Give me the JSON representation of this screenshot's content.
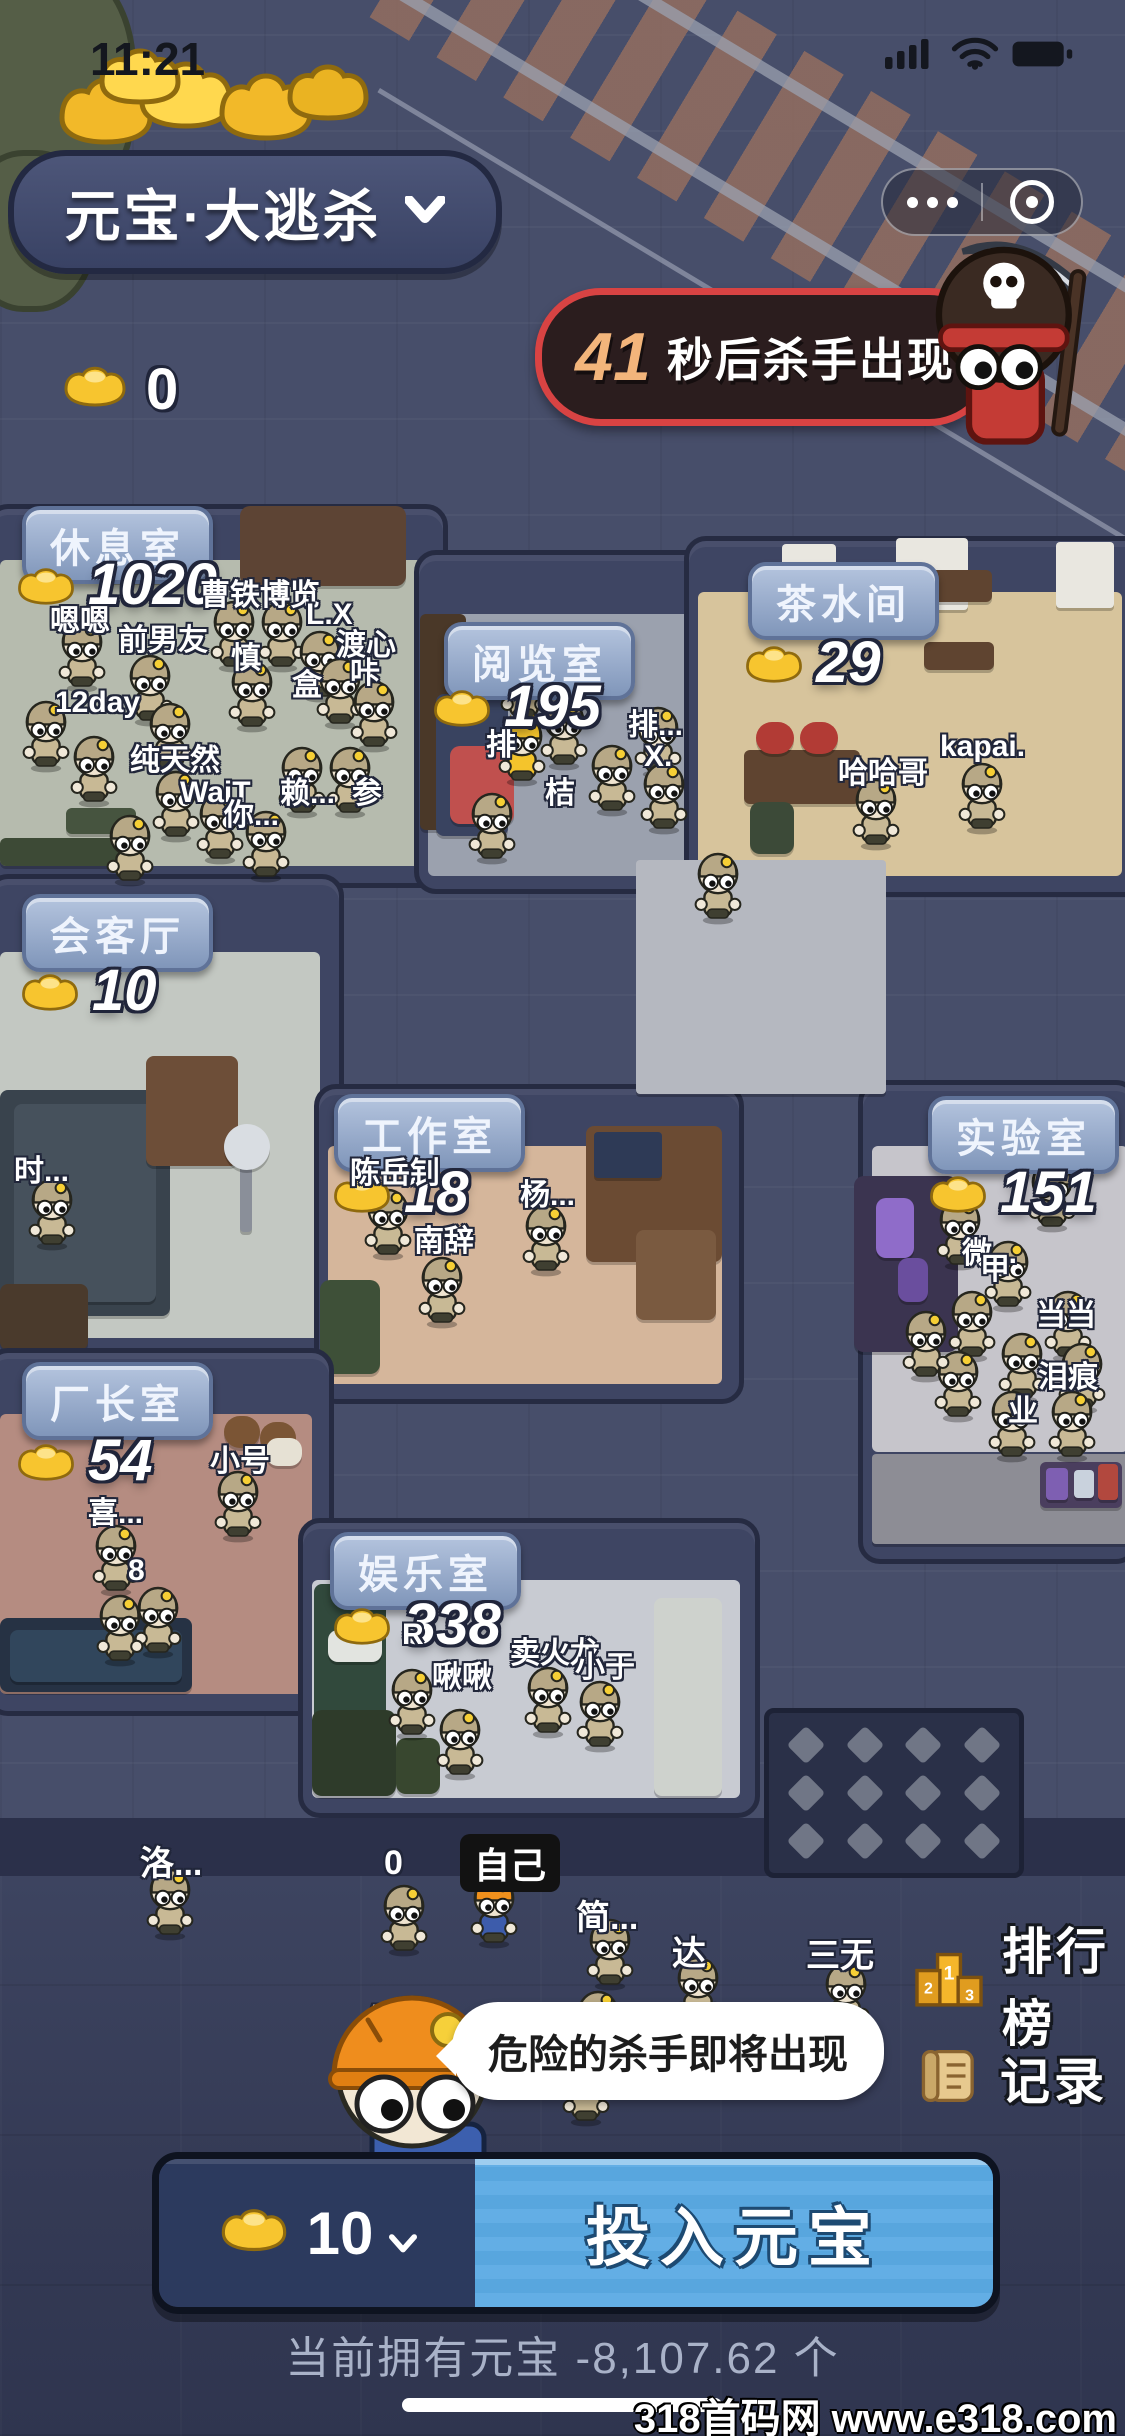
{
  "status_bar": {
    "time": "11:21"
  },
  "header": {
    "title": "元宝·大逃杀"
  },
  "banner": {
    "countdown": "41",
    "suffix": "秒后杀手出现"
  },
  "wallet": {
    "amount": "0"
  },
  "colors": {
    "banner_border": "#d84343",
    "banner_bg": "#2b1d1e",
    "countdown": "#f3b57b",
    "blue_btn": "#63aee5",
    "navy_btn": "#2c3a5e",
    "gold": "#f7c52f"
  },
  "rooms": [
    {
      "id": "rest",
      "label": "休息室",
      "count": "1020",
      "tile": "grid",
      "wall": [
        -14,
        504,
        452,
        374
      ],
      "floor": [
        0,
        560,
        422,
        306
      ],
      "floor_color": "#b6bbae",
      "label_pos": [
        22,
        506
      ],
      "count_pos": [
        14,
        556
      ],
      "furniture": [
        [
          104,
          512,
          82,
          70,
          "#6b4c38",
          8
        ],
        [
          240,
          506,
          166,
          80,
          "#5d4434",
          10
        ],
        [
          0,
          838,
          132,
          28,
          "#3d4a36",
          6
        ],
        [
          66,
          808,
          70,
          26,
          "#46543f",
          6
        ]
      ],
      "names": [
        [
          "嗯嗯",
          50,
          596
        ],
        [
          "前男友",
          118,
          615
        ],
        [
          "曹铁博览",
          200,
          570
        ],
        [
          "L.X",
          306,
          598
        ],
        [
          "渡心",
          336,
          620
        ],
        [
          "咔",
          350,
          648
        ],
        [
          "慎",
          231,
          633
        ],
        [
          "盒",
          292,
          660
        ],
        [
          "12day",
          55,
          686
        ],
        [
          "纯天然",
          130,
          735
        ],
        [
          "WaiT",
          180,
          776
        ],
        [
          "你...",
          224,
          790
        ],
        [
          "赖...",
          280,
          768
        ],
        [
          "参",
          352,
          768
        ]
      ],
      "chars": [
        [
          58,
          618
        ],
        [
          126,
          652
        ],
        [
          210,
          598
        ],
        [
          258,
          598
        ],
        [
          228,
          658
        ],
        [
          296,
          628
        ],
        [
          316,
          655
        ],
        [
          350,
          678
        ],
        [
          22,
          698
        ],
        [
          70,
          733
        ],
        [
          146,
          700
        ],
        [
          152,
          768
        ],
        [
          196,
          790
        ],
        [
          242,
          808
        ],
        [
          278,
          744
        ],
        [
          326,
          744
        ],
        [
          106,
          812
        ]
      ]
    },
    {
      "id": "reading",
      "label": "阅览室",
      "count": "195",
      "tile": "brick",
      "wall": [
        414,
        550,
        298,
        334
      ],
      "floor": [
        428,
        614,
        272,
        262
      ],
      "floor_color": "#9ba1ae",
      "label_pos": [
        444,
        622
      ],
      "count_pos": [
        430,
        678
      ],
      "furniture": [
        [
          420,
          614,
          46,
          216,
          "#4a3828",
          6
        ],
        [
          436,
          694,
          72,
          142,
          "#394360",
          8
        ],
        [
          450,
          746,
          64,
          78,
          "#c0504e",
          10
        ]
      ],
      "names": [
        [
          "排",
          486,
          720
        ],
        [
          "桔",
          545,
          768
        ],
        [
          "排...",
          628,
          700
        ],
        [
          "X.",
          644,
          740
        ]
      ],
      "chars": [
        [
          500,
          650
        ],
        [
          498,
          712,
          "crown"
        ],
        [
          540,
          696
        ],
        [
          588,
          742
        ],
        [
          468,
          790
        ],
        [
          634,
          704
        ],
        [
          640,
          760
        ]
      ]
    },
    {
      "id": "tea",
      "label": "茶水间",
      "count": "29",
      "tile": "grid",
      "wall": [
        684,
        536,
        455,
        351
      ],
      "floor": [
        698,
        592,
        424,
        284
      ],
      "floor_color": "#d7c49c",
      "label_pos": [
        748,
        562
      ],
      "count_pos": [
        742,
        634
      ],
      "furniture": [
        [
          782,
          544,
          54,
          64,
          "#e9e7e0",
          4
        ],
        [
          896,
          538,
          72,
          72,
          "#e9e7e0",
          4
        ],
        [
          1056,
          542,
          58,
          66,
          "#e9e7e0",
          4
        ],
        [
          922,
          570,
          70,
          32,
          "#5f4430",
          6
        ],
        [
          924,
          642,
          70,
          28,
          "#5f4430",
          6
        ],
        [
          744,
          750,
          116,
          54,
          "#5f4430",
          6
        ],
        [
          756,
          722,
          38,
          32,
          "#b23b35",
          16
        ],
        [
          800,
          722,
          38,
          32,
          "#b23b35",
          16
        ],
        [
          750,
          802,
          44,
          52,
          "#3c4a38",
          10
        ]
      ],
      "names": [
        [
          "哈哈哥",
          838,
          748
        ],
        [
          "kapai.",
          940,
          730
        ]
      ],
      "chars": [
        [
          852,
          776
        ],
        [
          958,
          760
        ]
      ]
    },
    {
      "id": "meeting",
      "label": "会客厅",
      "count": "10",
      "tile": "grid",
      "wall": [
        -14,
        874,
        348,
        476
      ],
      "floor": [
        0,
        952,
        320,
        386
      ],
      "floor_color": "#c3c8c2",
      "label_pos": [
        22,
        894
      ],
      "count_pos": [
        18,
        962
      ],
      "furniture": [
        [
          0,
          1090,
          170,
          226,
          "#39434d",
          8
        ],
        [
          14,
          1104,
          142,
          198,
          "#46515c",
          8
        ],
        [
          146,
          1056,
          92,
          110,
          "#6d4e38",
          8
        ],
        [
          240,
          1158,
          12,
          74,
          "#8a8f99",
          4
        ],
        [
          224,
          1124,
          46,
          46,
          "#d9dde2",
          23
        ],
        [
          0,
          1284,
          88,
          66,
          "#4a3a2c",
          8
        ]
      ],
      "names": [
        [
          "时...",
          14,
          1146
        ]
      ],
      "chars": [
        [
          28,
          1176
        ]
      ]
    },
    {
      "id": "work",
      "label": "工作室",
      "count": "18",
      "tile": "grid",
      "wall": [
        314,
        1084,
        420,
        310
      ],
      "floor": [
        328,
        1146,
        394,
        238
      ],
      "floor_color": "#d5b69b",
      "label_pos": [
        334,
        1094
      ],
      "count_pos": [
        330,
        1164
      ],
      "furniture": [
        [
          586,
          1126,
          136,
          136,
          "#6b4b33",
          8
        ],
        [
          594,
          1132,
          68,
          46,
          "#2e3a56",
          4
        ],
        [
          636,
          1230,
          80,
          90,
          "#7a5a40",
          8
        ],
        [
          320,
          1280,
          60,
          94,
          "#3e5038",
          10
        ]
      ],
      "names": [
        [
          "陈岳钊",
          350,
          1148
        ],
        [
          "南辞",
          414,
          1216
        ],
        [
          "杨...",
          520,
          1170
        ]
      ],
      "chars": [
        [
          364,
          1186
        ],
        [
          418,
          1254
        ],
        [
          522,
          1202
        ]
      ]
    },
    {
      "id": "lab",
      "label": "实验室",
      "count": "151",
      "tile": "grid",
      "wall": [
        858,
        1080,
        270,
        474
      ],
      "floor": [
        872,
        1146,
        256,
        306
      ],
      "floor_color": "#c6c5cb",
      "label_pos": [
        928,
        1096
      ],
      "count_pos": [
        926,
        1164
      ],
      "furniture": [
        [
          854,
          1176,
          104,
          176,
          "#3b3450",
          10
        ],
        [
          876,
          1198,
          38,
          60,
          "#8f6cc9",
          10
        ],
        [
          898,
          1258,
          30,
          44,
          "#6a4e9e",
          10
        ],
        [
          872,
          1454,
          256,
          90,
          "#8d8d95",
          4
        ],
        [
          1040,
          1462,
          82,
          46,
          "#4a3e5e",
          6
        ],
        [
          1046,
          1468,
          22,
          32,
          "#7e5fb2",
          4
        ],
        [
          1074,
          1470,
          20,
          28,
          "#c9d2dd",
          4
        ],
        [
          1098,
          1464,
          20,
          36,
          "#b2483e",
          4
        ]
      ],
      "names": [
        [
          "微...",
          962,
          1228
        ],
        [
          "甲",
          980,
          1244
        ],
        [
          "当当",
          1036,
          1290
        ],
        [
          "泪痕",
          1038,
          1352
        ],
        [
          "业",
          1008,
          1386
        ]
      ],
      "chars": [
        [
          1028,
          1158
        ],
        [
          936,
          1196
        ],
        [
          984,
          1238
        ],
        [
          948,
          1288
        ],
        [
          998,
          1330
        ],
        [
          1044,
          1288
        ],
        [
          1058,
          1340
        ],
        [
          934,
          1348
        ],
        [
          988,
          1388
        ],
        [
          1048,
          1388
        ],
        [
          902,
          1308
        ]
      ]
    },
    {
      "id": "boss",
      "label": "厂长室",
      "count": "54",
      "tile": "grid",
      "wall": [
        -14,
        1348,
        338,
        358
      ],
      "floor": [
        0,
        1414,
        312,
        280
      ],
      "floor_color": "#b58c81",
      "label_pos": [
        22,
        1362
      ],
      "count_pos": [
        14,
        1432
      ],
      "furniture": [
        [
          224,
          1416,
          36,
          32,
          "#7b5535",
          16
        ],
        [
          260,
          1422,
          36,
          32,
          "#7b5535",
          16
        ],
        [
          266,
          1438,
          36,
          28,
          "#e6e1d4",
          12
        ],
        [
          0,
          1618,
          192,
          74,
          "#263244",
          8
        ],
        [
          10,
          1630,
          172,
          52,
          "#31465c",
          8
        ]
      ],
      "names": [
        [
          "小号",
          210,
          1436
        ],
        [
          "喜...",
          88,
          1488
        ],
        [
          "8",
          128,
          1554
        ]
      ],
      "chars": [
        [
          214,
          1468
        ],
        [
          92,
          1522
        ],
        [
          134,
          1584
        ],
        [
          96,
          1592
        ]
      ]
    },
    {
      "id": "fun",
      "label": "娱乐室",
      "count": "338",
      "tile": "diag",
      "wall": [
        298,
        1518,
        452,
        290
      ],
      "floor": [
        312,
        1580,
        428,
        218
      ],
      "floor_color": "#c8cbd2",
      "label_pos": [
        330,
        1532
      ],
      "count_pos": [
        330,
        1596
      ],
      "furniture": [
        [
          314,
          1584,
          72,
          140,
          "#31493c",
          8
        ],
        [
          328,
          1630,
          54,
          32,
          "#e2e4e0",
          10
        ],
        [
          312,
          1710,
          84,
          86,
          "#2e3b2a",
          10
        ],
        [
          396,
          1738,
          44,
          56,
          "#38472f",
          10
        ]
      ],
      "names": [
        [
          "R",
          402,
          1618
        ],
        [
          "啾啾",
          432,
          1652
        ],
        [
          "卖火龙",
          510,
          1628
        ],
        [
          "小于",
          575,
          1642
        ]
      ],
      "chars": [
        [
          388,
          1666
        ],
        [
          436,
          1706
        ],
        [
          524,
          1664
        ],
        [
          576,
          1678
        ]
      ]
    }
  ],
  "corridor": {
    "patches": [
      [
        636,
        860,
        250,
        234,
        "#b5b8c0",
        4
      ],
      [
        654,
        1598,
        68,
        198,
        "#ced2cd",
        8
      ]
    ],
    "chars": [
      [
        694,
        850
      ]
    ],
    "vent": [
      764,
      1708,
      234,
      144
    ]
  },
  "bottom_area": {
    "names": [
      [
        "洛...",
        140,
        1836
      ],
      [
        "0",
        384,
        1844
      ],
      [
        "简...",
        576,
        1890
      ],
      [
        "达",
        672,
        1926
      ],
      [
        "三无",
        806,
        1928
      ],
      [
        "Apr...",
        364,
        1998
      ]
    ],
    "self_badge": {
      "text": "自己",
      "x": 460,
      "y": 1834
    },
    "chars": [
      [
        146,
        1866
      ],
      [
        380,
        1882
      ],
      [
        470,
        1874,
        "self"
      ],
      [
        586,
        1916
      ],
      [
        574,
        1988
      ],
      [
        562,
        2052
      ],
      [
        674,
        1954
      ],
      [
        822,
        1960
      ]
    ]
  },
  "side_buttons": [
    {
      "label": "排行榜"
    },
    {
      "label": "记录"
    }
  ],
  "speech_bubble": {
    "text": "危险的杀手即将出现"
  },
  "bet_bar": {
    "amount": "10",
    "button_label": "投入元宝"
  },
  "footer": {
    "balance": "当前拥有元宝 -8,107.62 个"
  },
  "watermark": "318首码网 www.e318.com"
}
